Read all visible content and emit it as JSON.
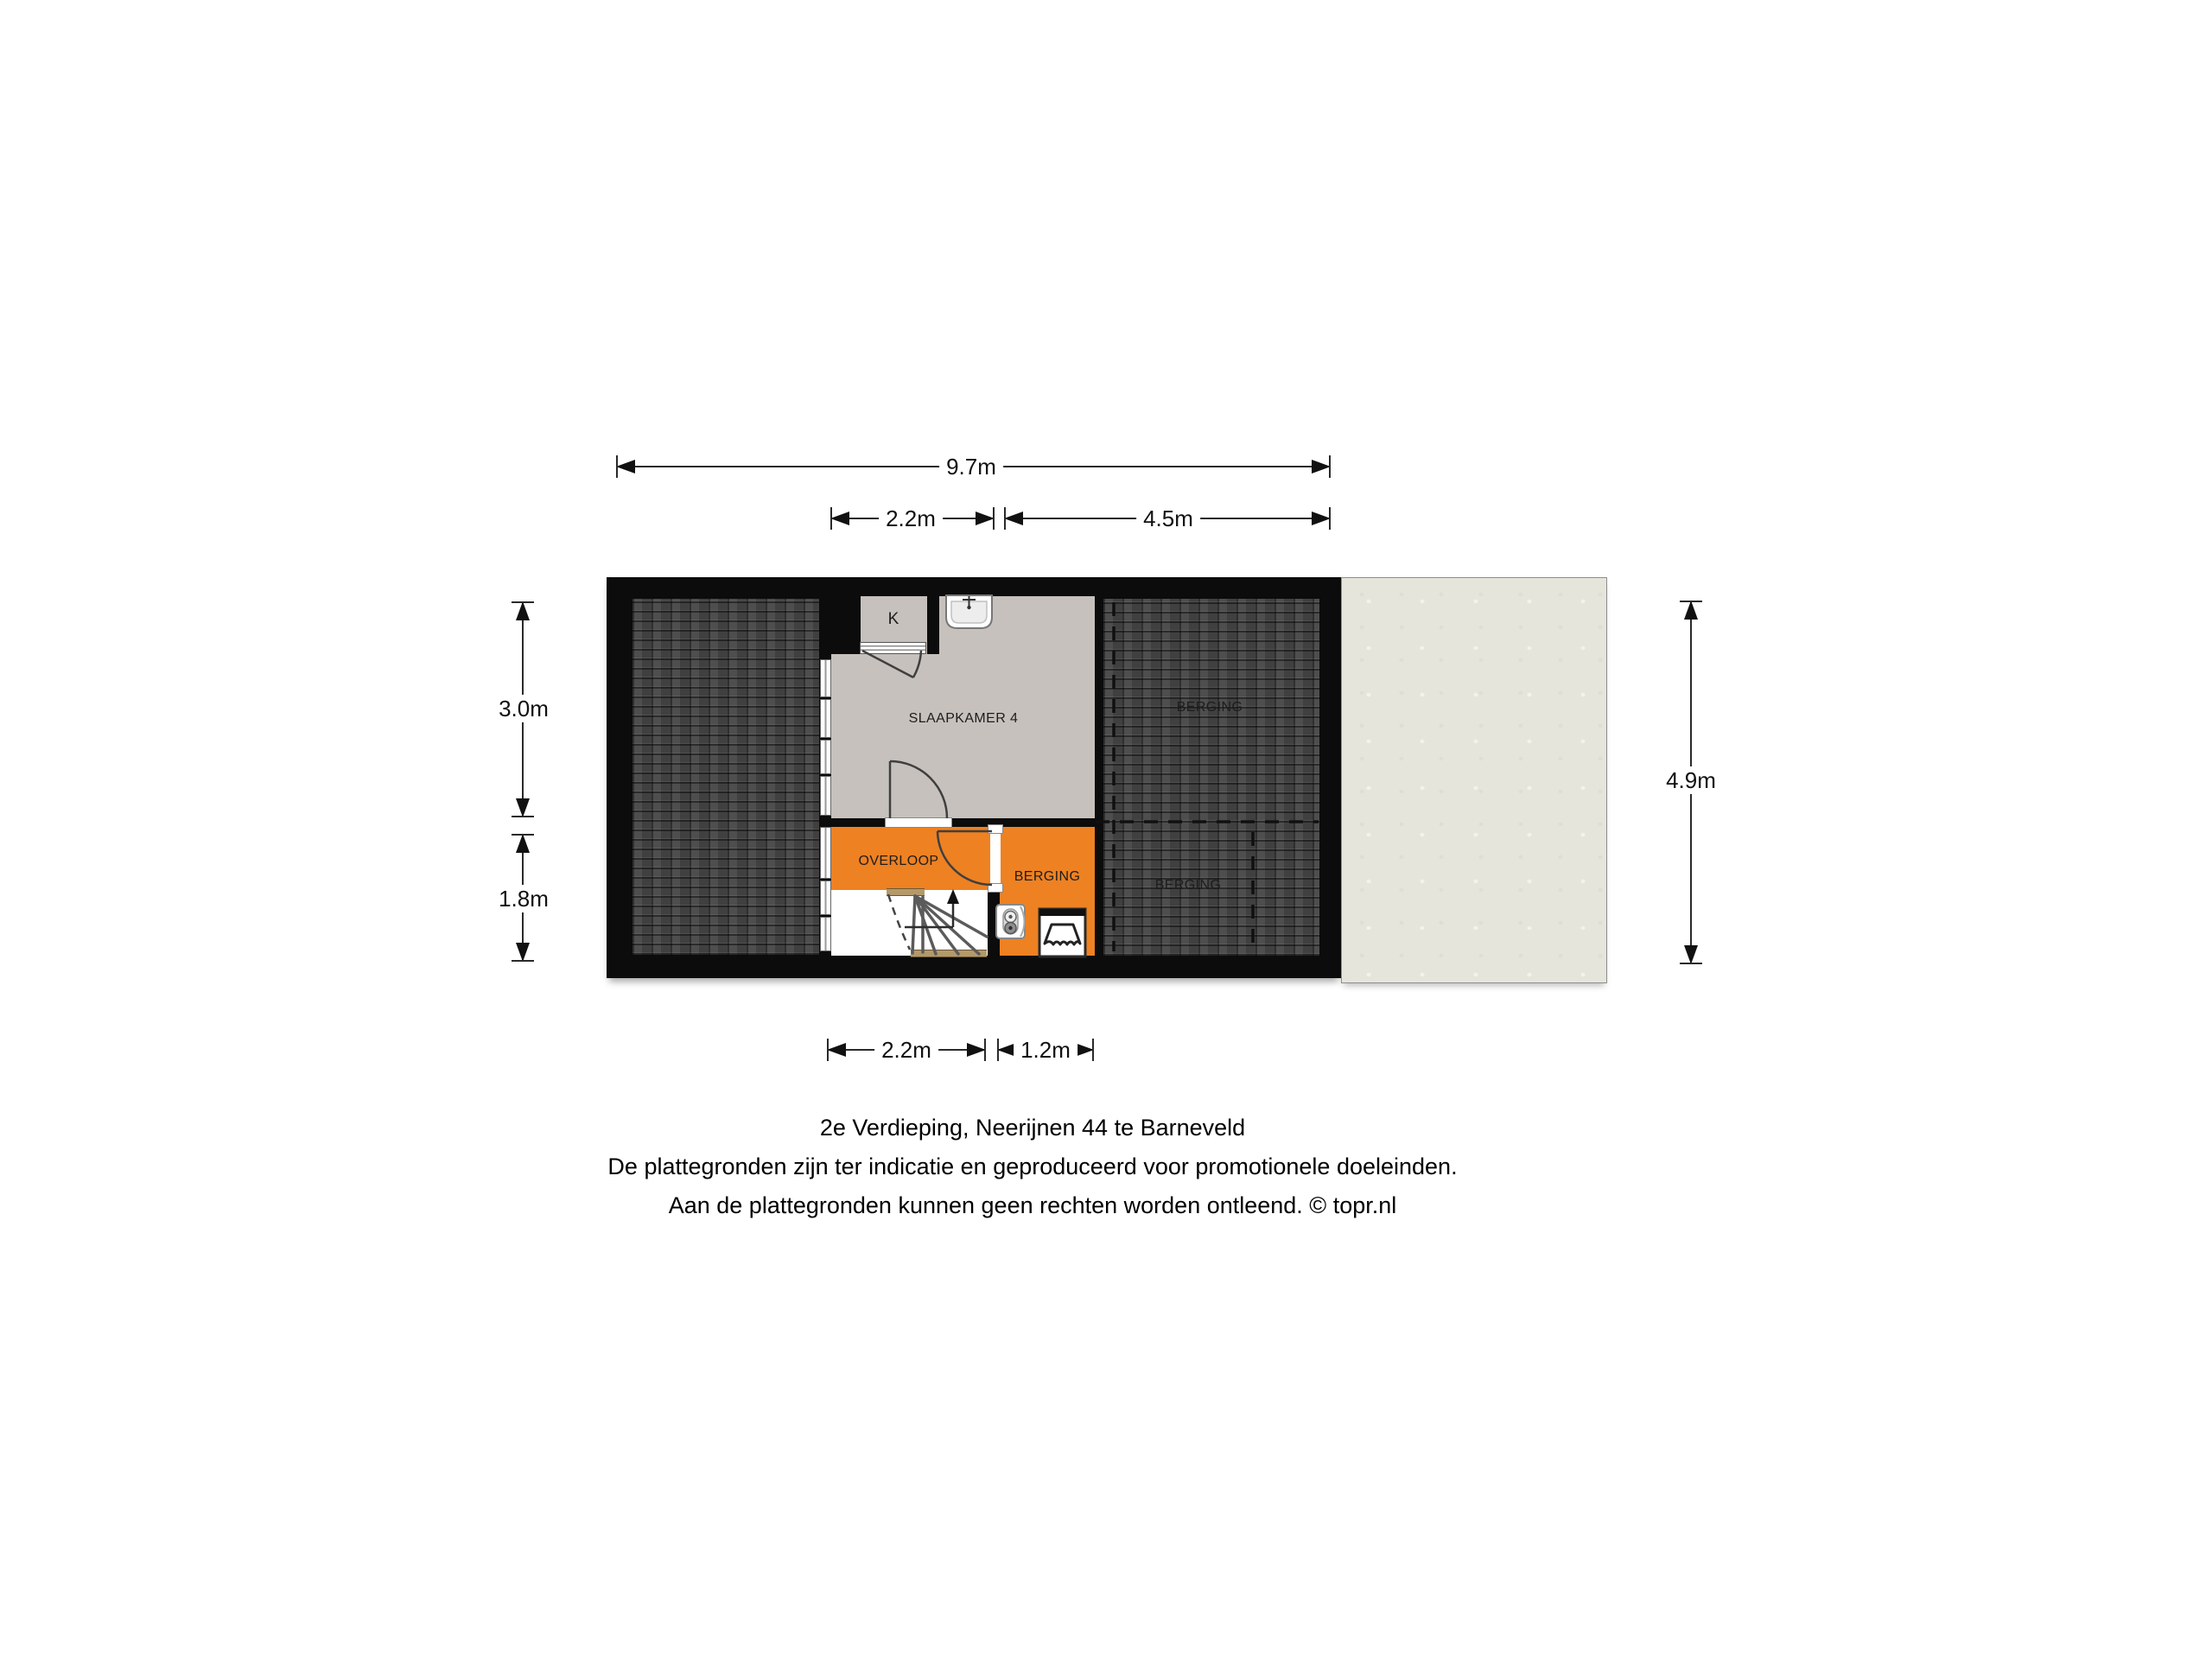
{
  "floorplan": {
    "name": "2e Verdieping Neerijnen 44",
    "rooms": {
      "slaapkamer4": "SLAAPKAMER 4",
      "overloop": "OVERLOOP",
      "berging_orange": "BERGING",
      "berging_upper": "BERGING",
      "berging_lower": "BERGING",
      "closet": "K"
    },
    "dimensions": {
      "total_width": "9.7m",
      "top_left_width": "2.2m",
      "top_right_width": "4.5m",
      "left_upper_height": "3.0m",
      "left_lower_height": "1.8m",
      "right_height": "4.9m",
      "bottom_left_width": "2.2m",
      "bottom_right_width": "1.2m"
    },
    "icons": [
      "sink-icon",
      "boiler-icon",
      "cv-unit-icon",
      "stairs-up-arrow",
      "door-swing-arc"
    ],
    "colors": {
      "wall": "#0c0c0c",
      "room_gray": "#c7c1bd",
      "room_orange": "#ee8122",
      "roof_dark": "#454545",
      "stair_tan": "#b3996b",
      "adjacent_beige": "#e6e5dc"
    }
  },
  "caption": {
    "line1": "2e Verdieping, Neerijnen 44 te Barneveld",
    "line2": "De plattegronden zijn ter indicatie en geproduceerd voor promotionele doeleinden.",
    "line3": "Aan de plattegronden kunnen geen rechten worden ontleend. © topr.nl"
  }
}
